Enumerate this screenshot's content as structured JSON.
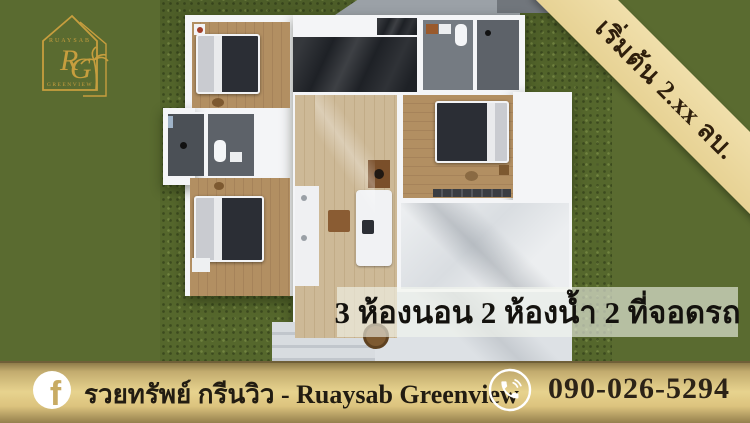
{
  "logo": {
    "monogram": "RG",
    "arc_top": "RUAYSAB",
    "arc_bottom": "GREENVIEW"
  },
  "price_ribbon": {
    "text": "เริ่มต้น 2.xx ลบ."
  },
  "features_banner": {
    "text": "3 ห้องนอน 2 ห้องน้ำ 2 ที่จอดรถ"
  },
  "footer": {
    "page_name": "รวยทรัพย์ กรีนวิว - Ruaysab Greenview",
    "phone_number": "090-026-5294"
  },
  "colors": {
    "background_olive": "#5a6b30",
    "grass_render": "#55672c",
    "ribbon_tan": "#ecd9a2",
    "ribbon_text": "#2f1f0c",
    "banner_overlay": "rgba(243,247,238,0.60)",
    "footer_gold": "#e7d38e",
    "logo_gold": "#c79e3e",
    "text_dark": "#221c12",
    "house_wall_white": "#f4f5f7",
    "wood_floor": "#b28f62",
    "dark_marble": "#1e2126"
  },
  "floor_plan": {
    "view": "top-down 3d render",
    "rooms": [
      "bedroom-top-left",
      "kitchen-dark-counter",
      "bathroom-top",
      "shower-room",
      "bedroom-right",
      "bathroom-left",
      "bedroom-bottom-left",
      "living-area",
      "garage",
      "driveway",
      "porch-steps"
    ]
  }
}
